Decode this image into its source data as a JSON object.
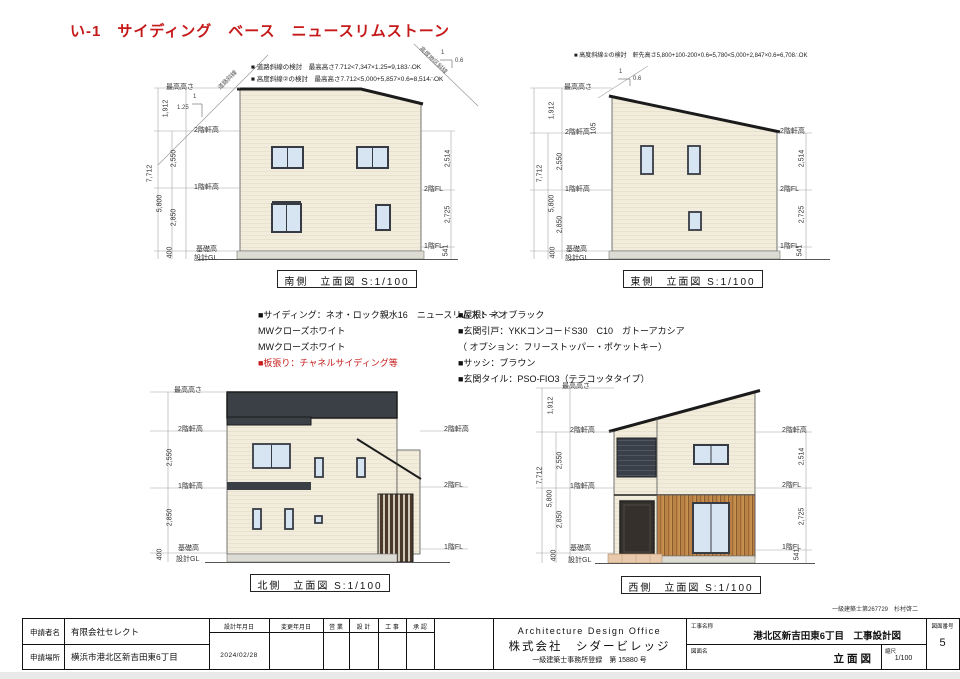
{
  "title": "い-1　サイディング　ベース　ニュースリムストーン",
  "notes": {
    "south1": "■ 道路斜線の検討　最高高さ7.712<7,347×1.25=9,183∴OK",
    "south2": "■ 高度斜線②の検討　最高高さ7.712<5,000+5,857×0.6=8,514∴OK",
    "east1": "■ 高度斜線①の検討　軒先高さ5,800+100-200×0.6=5,780<5,000+2,847×0.6=6,708∴OK",
    "road": "道路斜線",
    "district": "高度地区斜線",
    "one": "1",
    "slope125": "1.25",
    "slope06": "0.6"
  },
  "views": {
    "south": "南側　立面図 S:1/100",
    "east": "東側　立面図 S:1/100",
    "north": "北側　立面図 S:1/100",
    "west": "西側　立面図 S:1/100"
  },
  "dims": {
    "max": "最高高さ",
    "eave2": "2階軒高",
    "eave1": "1階軒高",
    "base": "基礎高",
    "gl": "設計GL",
    "fl2": "2階FL",
    "fl1": "1階FL",
    "d1912": "1,912",
    "d2550": "2,550",
    "d2850": "2,850",
    "d400": "400",
    "d5800": "5,800",
    "d7712": "7,712",
    "d2514": "2,514",
    "d2725": "2,725",
    "d541": "541",
    "d105": "105"
  },
  "specs": {
    "left": [
      "■サイディング：ネオ・ロック親水16　ニュースリムストーン",
      "MWクローズホワイト",
      "MWクローズホワイト",
      "■板張り：チャネルサイディング等"
    ],
    "right": [
      "■屋根：ネオブラック",
      "■玄関引戸：YKKコンコードS30　C10　ガトーアカシア",
      "（ オプション：フリーストッパー・ポケットキー）",
      "■サッシ：ブラウン",
      "■玄関タイル：PSO-FIO3（テラコッタタイプ）"
    ]
  },
  "titleblock": {
    "applicant_label": "申請者名",
    "applicant": "有限会社セレクト",
    "location_label": "申請場所",
    "location": "横浜市港北区新吉田東6丁目",
    "design_date_label": "設計年月日",
    "design_date": "2024/02/28",
    "change_date_label": "変更年月日",
    "sales_label": "営 業",
    "design_label": "設 計",
    "construction_label": "工 事",
    "approval_label": "承 認",
    "office_en": "Architecture Design Office",
    "office_jp": "株式会社　シダービレッジ",
    "office_reg": "一級建築士事務所登録　第 15880 号",
    "project_label": "工事名称",
    "project": "港北区新吉田東6丁目　工事設計図",
    "drawing_label": "図面名",
    "drawing": "立面図",
    "scale_label": "縮尺",
    "scale": "1/100",
    "number_label": "図面番号",
    "number": "5",
    "architect": "一級建築士第267729　杉村啓二"
  },
  "colors": {
    "accent_red": "#c61a1a",
    "wall_cream": "#f1ecdc",
    "roof_charcoal": "#3b4046",
    "wood_brown": "#bb8248",
    "window_blue": "#d7e5f2",
    "slat_dark": "#4a382a",
    "foundation_gray": "#dcdbd4",
    "terracotta": "#e9c9ab"
  }
}
